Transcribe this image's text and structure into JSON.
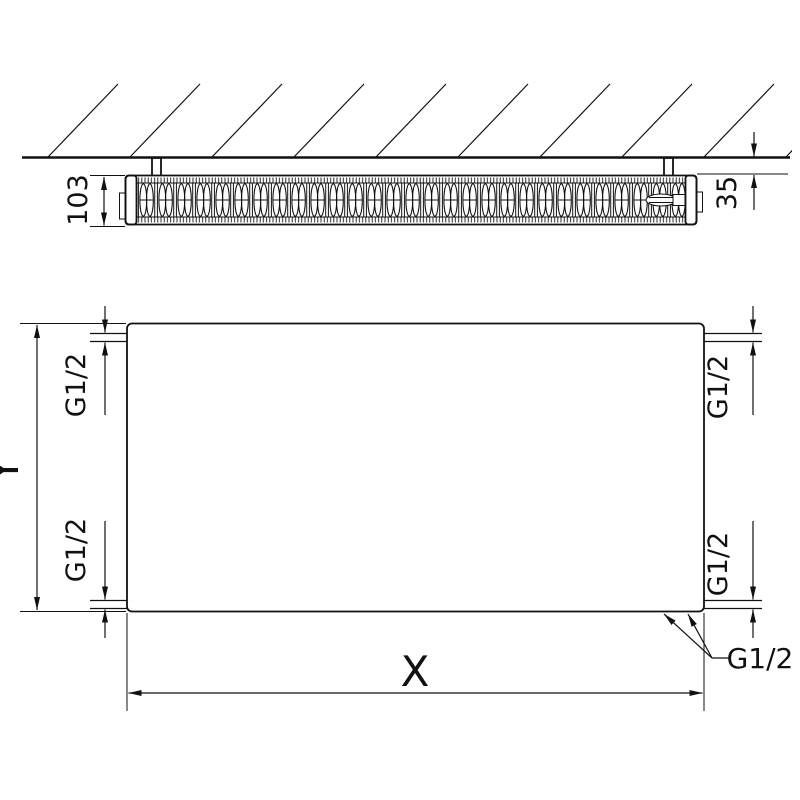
{
  "colors": {
    "background": "#ffffff",
    "line": "#111111"
  },
  "top_view": {
    "depth_label": "103",
    "wall_distance_label": "35"
  },
  "front_view": {
    "height_label": "Y",
    "width_label": "X",
    "ports": {
      "top_left": "G1/2",
      "bottom_left": "G1/2",
      "top_right": "G1/2",
      "bottom_right": "G1/2",
      "bottom_leader": "G1/2"
    }
  }
}
